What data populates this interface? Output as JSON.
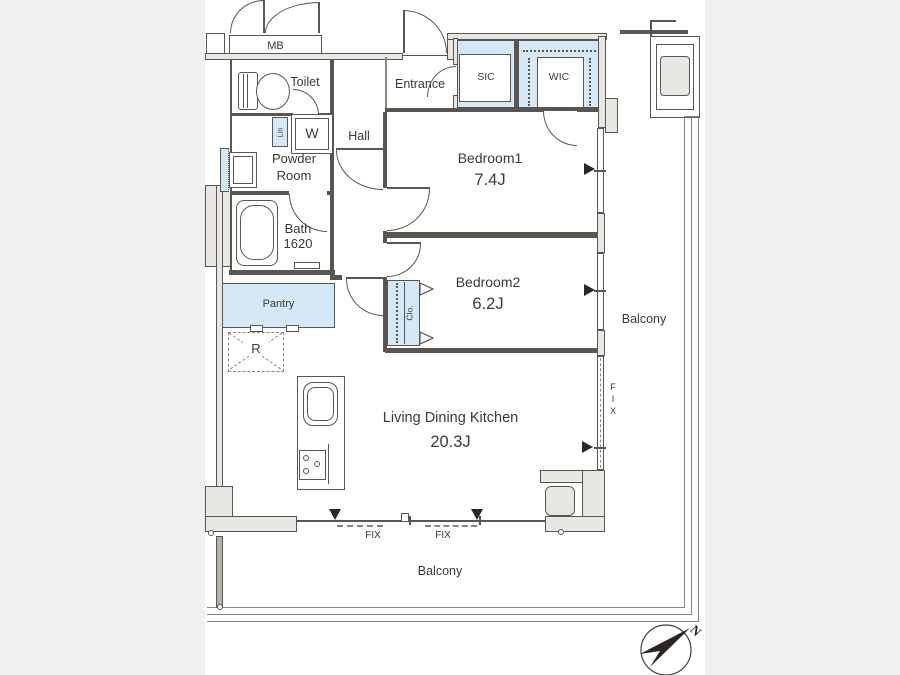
{
  "rooms": {
    "toilet": "Toilet",
    "entrance": "Entrance",
    "hall": "Hall",
    "powder_room": "Powder Room",
    "bath": "Bath",
    "bath_size": "1620",
    "bedroom1": "Bedroom1",
    "bedroom1_size": "7.4J",
    "bedroom2": "Bedroom2",
    "bedroom2_size": "6.2J",
    "ldk": "Living Dining Kitchen",
    "ldk_size": "20.3J",
    "balcony_right": "Balcony",
    "balcony_bottom": "Balcony"
  },
  "storage": {
    "meter_box": "MB",
    "shoe_closet": "SIC",
    "walkin_closet": "WIC",
    "linen": "Lin",
    "closet": "Clo.",
    "washer": "W",
    "pantry": "Pantry",
    "fridge": "R"
  },
  "windows": {
    "fix_bottom_1": "FIX",
    "fix_bottom_2": "FIX",
    "fix_right": "FIX"
  },
  "compass": {
    "north": "N"
  },
  "colors": {
    "background": "#f0f0f0",
    "plan": "#ffffff",
    "closet_fill": "#d4e8f7",
    "wall_fill": "#e9e7e3",
    "line": "#5a554f"
  }
}
